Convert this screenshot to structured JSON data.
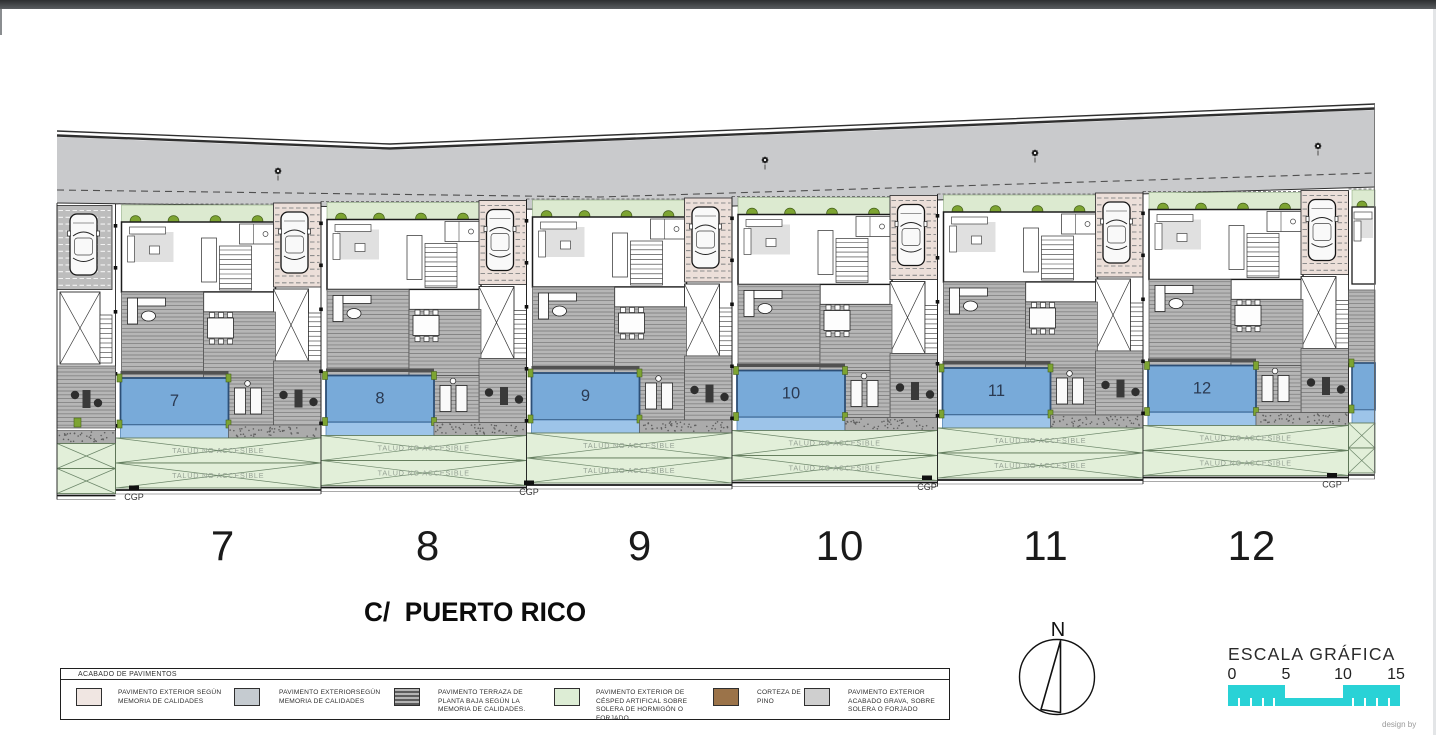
{
  "plan": {
    "units": [
      "7",
      "8",
      "9",
      "10",
      "11",
      "12"
    ],
    "talud_label": "TALUD NO ACCESIBLE",
    "cgp_label": "CGP",
    "colors": {
      "road": "#c9cacc",
      "road_line": "#2f2f2f",
      "green_strip": "#dcead0",
      "bush": "#7da432",
      "bush_dark": "#46611c",
      "pool": "#78aad9",
      "pool_border": "#2d4f76",
      "pool_shallow": "#9dc4e9",
      "pool_number": "#2b3a52",
      "terrace": "#b6b6b6",
      "terrace_line": "#858585",
      "drive_pink": "#ecdfd9",
      "drive_gray": "#bdbdbd",
      "gravel": "#ababab",
      "talud_fill": "#e2efd9",
      "talud_line": "#6d876a",
      "talud_text": "#96a295",
      "wall": "#1c1c1c",
      "cyan": "#29d2d6"
    }
  },
  "labels": {
    "street": "C/  PUERTO RICO",
    "lots": [
      "7",
      "8",
      "9",
      "10",
      "11",
      "12"
    ],
    "credit": "design by"
  },
  "north_label": "N",
  "legend": {
    "title": "ACABADO DE PAVIMENTOS",
    "items": [
      {
        "swatch": "#f0e6e2",
        "label": "PAVIMENTO EXTERIOR SEGÚN MEMORIA DE CALIDADES"
      },
      {
        "swatch": "#c5cbd0",
        "label": "PAVIMENTO EXTERIORSEGÚN MEMORIA DE CALIDADES"
      },
      {
        "swatch": "#9b9b9b",
        "label": "PAVIMENTO TERRAZA DE PLANTA BAJA SEGÚN LA MEMORIA DE CALIDADES."
      },
      {
        "swatch": "#ddedd5",
        "label": "PAVIMENTO EXTERIOR DE CÉSPED ARTIFICAL SOBRE SOLERA DE HORMIGÓN O FORJADO"
      },
      {
        "swatch": "#9b7349",
        "label": "CORTEZA DE PINO"
      },
      {
        "swatch": "#cfcfcf",
        "label": "PAVIMENTO EXTERIOR ACABADO GRAVA, SOBRE SOLERA O FORJADO"
      }
    ]
  },
  "scale_bar": {
    "title": "ESCALA GRÁFICA",
    "ticks": [
      "0",
      "5",
      "10",
      "15"
    ]
  }
}
